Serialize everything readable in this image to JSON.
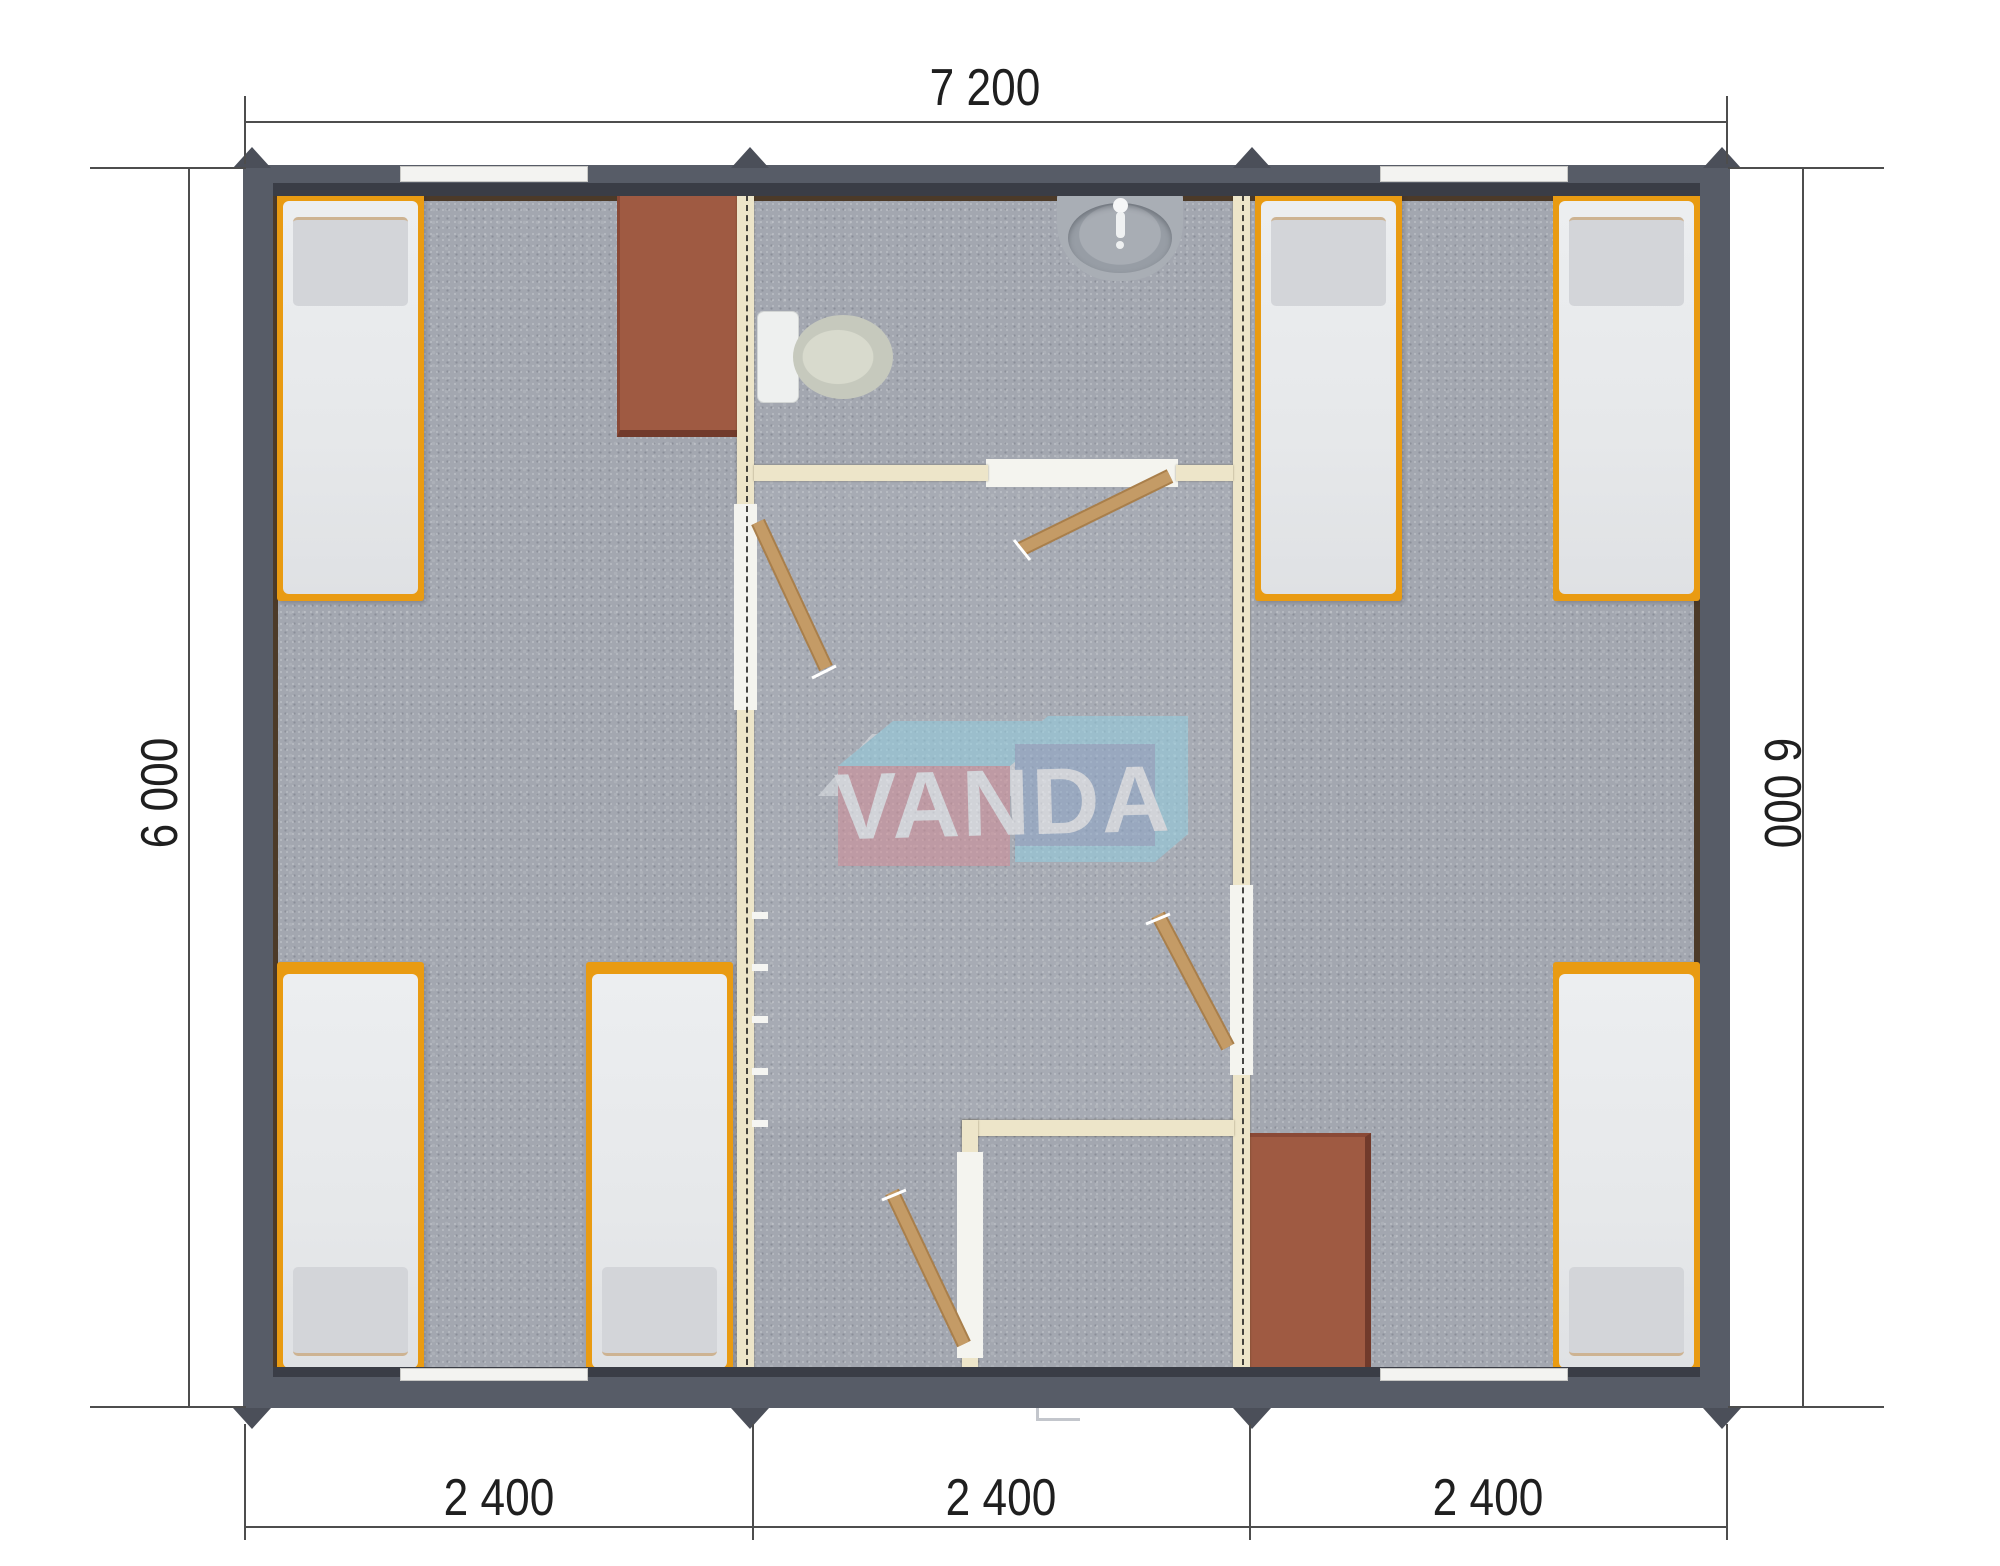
{
  "dimensions": {
    "overall_width_mm": "7 200",
    "side_height_left_mm": "6 000",
    "side_height_right_mm": "6 000",
    "module_widths_mm": [
      "2 400",
      "2 400",
      "2 400"
    ]
  },
  "watermark": {
    "brand": "VANDA"
  },
  "colors": {
    "wall": "#575c67",
    "wall_lip": "#3a3d46",
    "wall_lining": "#4c3a28",
    "floor": "#a3a7b0",
    "partition": "#ede5c9",
    "jamb": "#f4f4ef",
    "bed_frame": "#e99b12",
    "mattress": "#e9eaec",
    "pillow": "#d3d5d9",
    "pillow_edge": "#cdb392",
    "table": "#9f5a42",
    "table_edge": "#713a2b",
    "door_wood": "#c49b66",
    "door_edge": "#a97f4b",
    "toilet": "#eef0ef",
    "bowl": "#c6c9bd",
    "sink": "#a9aeb5",
    "sink_basin": "#979da5",
    "threshold": "#2e3138",
    "lug": "#4b4f59",
    "dim_line": "#4d4d4d",
    "dim_text": "#1f1f1f",
    "wm_pink": "#d28d97",
    "wm_blue": "#8ea7c8",
    "wm_cyan": "#93cfe1",
    "wm_back": "#e8eaec",
    "wm_text": "#f4f5f7",
    "window": "#f3f3f1"
  }
}
